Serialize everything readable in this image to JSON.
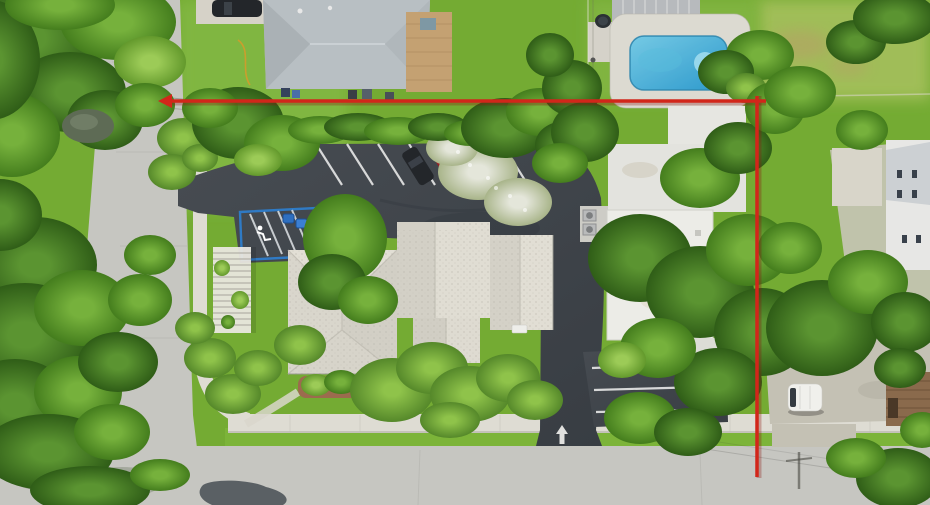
{
  "scene": {
    "type": "aerial-drone-photograph",
    "description": "Top-down aerial view of a corner commercial property outlined with a red boundary annotation: tiled hip-roof office building with curved parking lot and angled spaces, neighboring house with swimming pool to the north, flat-roof commercial building to the east, tree-lined concrete streets on the west and south.",
    "visible_text": []
  },
  "palette": {
    "grass_base": "#74ab33",
    "grass_light": "#84b944",
    "field_light": "#a3bf5a",
    "road": "#c6c6c1",
    "sidewalk": "#dedcd3",
    "asphalt_dark": "#41464c",
    "stripe_white": "#e8e8e8",
    "roof_main": "#dbd8ce",
    "roof_flat": "#ecece7",
    "roof_house": "#b8bfc3",
    "pool_water": "#3fa9d4",
    "pool_deck": "#dcdad1",
    "boundary_red": "#d2261a",
    "boundary_shadow": "#8c1510",
    "car_red": "#9c1f24",
    "car_dark": "#23262a",
    "car_white": "#e8e8e6",
    "van_white": "#f0f0ec",
    "handicap_blue": "#2d7fd1",
    "mulch": "#9c6b4e",
    "shed_brown": "#8a6a4c",
    "gravel": "#c4c1b4"
  },
  "boundary": {
    "color": "#d2261a",
    "stroke_width": 3.5,
    "h_x1": 166,
    "h_x2": 766,
    "h_y": 101,
    "v_x": 757,
    "v_y1": 96,
    "v_y2": 477
  },
  "features": [
    "subject-parcel-boundary",
    "office-building-tile-roof",
    "parking-lot",
    "handicap-stall",
    "swimming-pool",
    "neighbor-house-roof",
    "flat-roof-commercial-building",
    "white-van",
    "red-car",
    "dark-car",
    "white-car",
    "west-street",
    "south-street",
    "sidewalk",
    "tree-canopy",
    "palm-trees",
    "gravel-lot",
    "wood-shed",
    "pergola",
    "exit-arrow-marking"
  ]
}
